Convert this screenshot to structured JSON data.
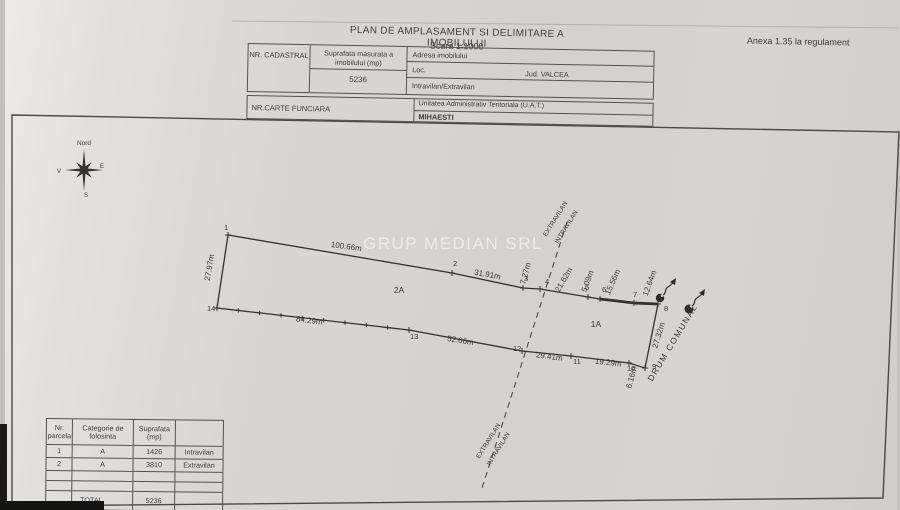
{
  "meta": {
    "annex": "Anexa 1.35 la regulament"
  },
  "title": {
    "main": "PLAN DE AMPLASAMENT SI DELIMITARE A IMOBILULUI",
    "scale": "Scara 1:1000"
  },
  "header_table": {
    "nr_cadastral_label": "NR. CADASTRAL",
    "suprafata_label": "Suprafata masurata a imobilului (mp)",
    "suprafata_value": "5236",
    "adresa_label": "Adresa imobilului",
    "loc_label": "Loc.",
    "jud_value": "Jud. VALCEA",
    "intravilan_label": "Intravilan/Extravilan",
    "carte_funciara_label": "NR.CARTE FUNCIARA",
    "uat_label": "Unitatea Administrativ Teritoriala (U.A.T.)",
    "uat_value": "MIHAESTI"
  },
  "compass": {
    "north": "Nord",
    "east": "E",
    "south": "S",
    "west": "V"
  },
  "watermark": "GRUP MEDIAN SRL",
  "plot": {
    "vertices": [
      {
        "n": "1",
        "x": 228,
        "y": 235,
        "lx": 224,
        "ly": 230
      },
      {
        "n": "2",
        "x": 452,
        "y": 273,
        "lx": 453,
        "ly": 266
      },
      {
        "n": "3",
        "x": 523,
        "y": 288,
        "lx": 524,
        "ly": 281
      },
      {
        "n": "4",
        "x": 540,
        "y": 289,
        "lx": 545,
        "ly": 284
      },
      {
        "n": "5",
        "x": 588,
        "y": 297,
        "lx": 585,
        "ly": 290
      },
      {
        "n": "6",
        "x": 600,
        "y": 299,
        "lx": 602,
        "ly": 292
      },
      {
        "n": "7",
        "x": 634,
        "y": 303,
        "lx": 633,
        "ly": 297
      },
      {
        "n": "8",
        "x": 658,
        "y": 304,
        "lx": 664,
        "ly": 311
      },
      {
        "n": "9",
        "x": 645,
        "y": 368,
        "lx": 652,
        "ly": 369
      },
      {
        "n": "10",
        "x": 629,
        "y": 363,
        "lx": 627,
        "ly": 371
      },
      {
        "n": "11",
        "x": 571,
        "y": 356,
        "lx": 573,
        "ly": 364
      },
      {
        "n": "12",
        "x": 522,
        "y": 351,
        "lx": 513,
        "ly": 351
      },
      {
        "n": "13",
        "x": 409,
        "y": 330,
        "lx": 410,
        "ly": 339
      },
      {
        "n": "14",
        "x": 217,
        "y": 308,
        "lx": 207,
        "ly": 311
      }
    ],
    "fence_ticks": {
      "from": "14",
      "to": "13",
      "count": 8
    },
    "labels": [
      {
        "t": "100.66m",
        "x": 346,
        "y": 249,
        "r": 8
      },
      {
        "t": "31.91m",
        "x": 487,
        "y": 277,
        "r": 10
      },
      {
        "t": "7.27m",
        "x": 528,
        "y": 274,
        "r": -75
      },
      {
        "t": "21.62m",
        "x": 566,
        "y": 281,
        "r": -60
      },
      {
        "t": "5.09m",
        "x": 590,
        "y": 282,
        "r": -70
      },
      {
        "t": "15.56m",
        "x": 615,
        "y": 283,
        "r": -66
      },
      {
        "t": "12.64m",
        "x": 652,
        "y": 284,
        "r": -70
      },
      {
        "t": "27.97m",
        "x": 212,
        "y": 268,
        "r": -80
      },
      {
        "t": "84.29m",
        "x": 309,
        "y": 323,
        "r": 7
      },
      {
        "t": "52.66m",
        "x": 460,
        "y": 343,
        "r": 9
      },
      {
        "t": "29.41m",
        "x": 549,
        "y": 359,
        "r": 7
      },
      {
        "t": "19.29m",
        "x": 608,
        "y": 365,
        "r": 6
      },
      {
        "t": "6.16m",
        "x": 634,
        "y": 378,
        "r": -75
      },
      {
        "t": "27.32m",
        "x": 661,
        "y": 336,
        "r": -73
      },
      {
        "t": "2A",
        "x": 399,
        "y": 293,
        "r": 0,
        "s": 8.5,
        "n": "zone-label"
      },
      {
        "t": "1A",
        "x": 596,
        "y": 327,
        "r": 0,
        "s": 8.5,
        "n": "zone-label"
      },
      {
        "t": "EXTRAVILAN",
        "x": 557,
        "y": 220,
        "r": -58,
        "s": 6.5,
        "n": "boundary-zone-label"
      },
      {
        "t": "INTRAVILAN",
        "x": 568,
        "y": 228,
        "r": -58,
        "s": 6.5,
        "n": "boundary-zone-label"
      },
      {
        "t": "EXTRAVILAN",
        "x": 490,
        "y": 442,
        "r": -58,
        "s": 6.5,
        "n": "boundary-zone-label"
      },
      {
        "t": "INTRAVILAN",
        "x": 500,
        "y": 450,
        "r": -58,
        "s": 6.5,
        "n": "boundary-zone-label"
      },
      {
        "t": "DRUM  COMUNAL",
        "x": 675,
        "y": 344,
        "r": -59,
        "s": 8.5,
        "ls": 1.5,
        "n": "road-label"
      }
    ]
  },
  "parcel_table": {
    "headers": [
      "Nr. parcela",
      "Categorie de folosinta",
      "Suprafata (mp)",
      ""
    ],
    "rows": [
      [
        "1",
        "A",
        "1426",
        "Intravilan"
      ],
      [
        "2",
        "A",
        "3810",
        "Extravilan"
      ],
      [
        "",
        "",
        "",
        ""
      ],
      [
        "",
        "",
        "",
        ""
      ]
    ],
    "total_label": "TOTAL",
    "total_value": "5236"
  },
  "colors": {
    "ink": "#3a3937",
    "paper": "#d6d4d1"
  }
}
